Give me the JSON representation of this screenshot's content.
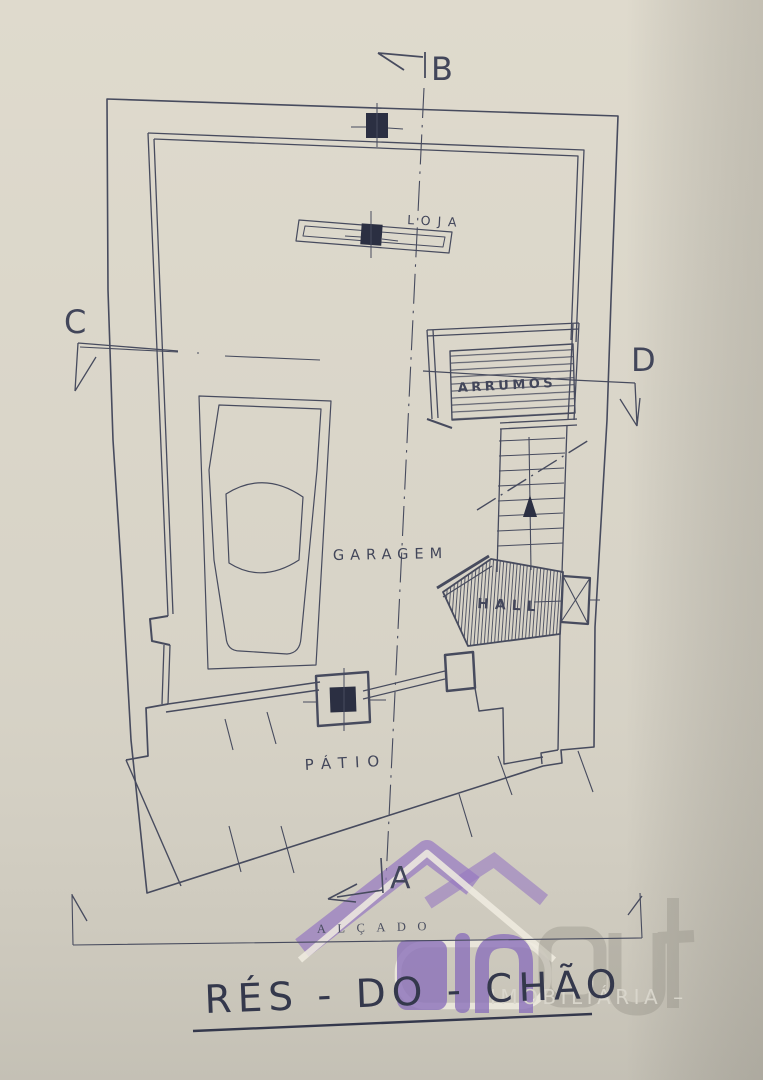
{
  "document": {
    "title": "RÉS - DO - CHÃO",
    "elevation_label": "ALÇADO"
  },
  "plan": {
    "rooms": [
      {
        "id": "loja",
        "label": "LOJA"
      },
      {
        "id": "arrumos",
        "label": "ARRUMOS"
      },
      {
        "id": "garagem",
        "label": "GARAGEM"
      },
      {
        "id": "hall",
        "label": "HALL"
      },
      {
        "id": "patio",
        "label": "PÁTIO"
      }
    ],
    "section_markers": [
      {
        "label": "A"
      },
      {
        "label": "B"
      },
      {
        "label": "C"
      },
      {
        "label": "D"
      }
    ]
  },
  "watermark": {
    "brand_in": "in",
    "brand_out": "out",
    "tagline": "IMOBILIÁRIA –"
  },
  "colors": {
    "paper": "#d6d2c6",
    "ink": "#474b5e",
    "column_fill": "#2b2f42",
    "title_ink": "#34384c",
    "watermark_purple": "#8b71ba",
    "watermark_grey": "#8f8c82",
    "watermark_white": "#f0ece1",
    "watermark_text": "#dad7cd"
  }
}
